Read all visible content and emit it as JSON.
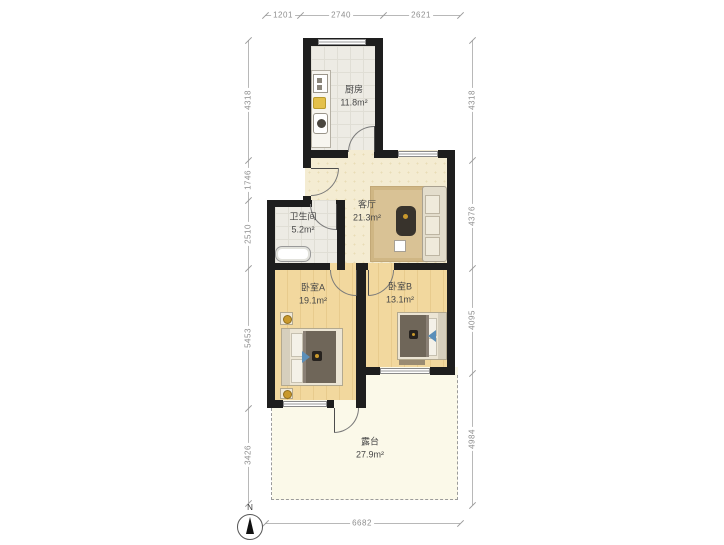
{
  "rooms": {
    "kitchen": {
      "name": "厨房",
      "area": "11.8m²"
    },
    "living": {
      "name": "客厅",
      "area": "21.3m²"
    },
    "bathroom": {
      "name": "卫生间",
      "area": "5.2m²"
    },
    "bedroomA": {
      "name": "卧室A",
      "area": "19.1m²"
    },
    "bedroomB": {
      "name": "卧室B",
      "area": "13.1m²"
    },
    "terrace": {
      "name": "露台",
      "area": "27.9m²"
    }
  },
  "dimensions": {
    "top": [
      "1201",
      "2740",
      "2621"
    ],
    "left": [
      "4318",
      "1746",
      "2510",
      "5453",
      "3426"
    ],
    "right": [
      "4318",
      "4376",
      "4095",
      "4984"
    ],
    "bottom": [
      "6682"
    ]
  },
  "compass": {
    "north_label": "N"
  },
  "colors": {
    "wall": "#1e1e1e",
    "living_floor": "#f4ecd2",
    "tile_floor": "#edebe4",
    "bedroom_floor": "#f2d89e",
    "terrace_floor": "#fbf9e9",
    "rug": "#d9c295",
    "accent_blue": "#5b8fb9",
    "lamp_gold": "#c9992c",
    "dimension_text": "#8e8e8e"
  }
}
